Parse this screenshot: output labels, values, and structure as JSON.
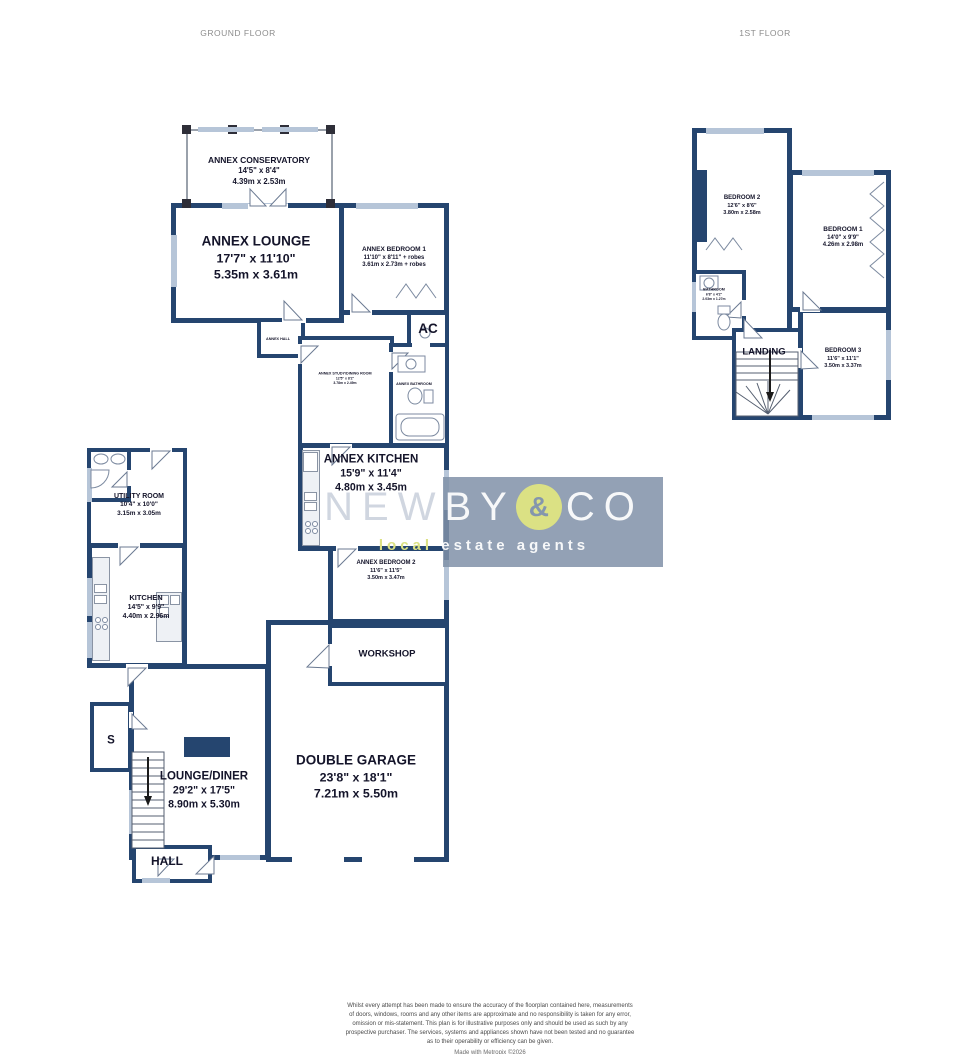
{
  "headers": {
    "ground_floor": "GROUND FLOOR",
    "first_floor": "1ST FLOOR"
  },
  "colors": {
    "wall": "#25456f",
    "window": "#b6c5d8",
    "watermark_band": "#8090a8",
    "logo_accent": "#dbe184"
  },
  "ground_floor": {
    "annex_conservatory": {
      "name": "ANNEX CONSERVATORY",
      "imperial": "14'5\" x 8'4\"",
      "metric": "4.39m x 2.53m"
    },
    "annex_lounge": {
      "name": "ANNEX LOUNGE",
      "imperial": "17'7\" x 11'10\"",
      "metric": "5.35m x 3.61m"
    },
    "annex_bedroom_1": {
      "name": "ANNEX BEDROOM 1",
      "imperial": "11'10\" x 8'11\" + robes",
      "metric": "3.61m x 2.73m + robes"
    },
    "ac": {
      "name": "AC"
    },
    "annex_hall": {
      "name": "ANNEX HALL"
    },
    "annex_study_dining": {
      "name": "ANNEX STUDY/DINING ROOM",
      "imperial": "12'5\" x 8'2\"",
      "metric": "3.78m x 2.49m"
    },
    "annex_bathroom": {
      "name": "ANNEX BATHROOM"
    },
    "annex_kitchen": {
      "name": "ANNEX KITCHEN",
      "imperial": "15'9\" x 11'4\"",
      "metric": "4.80m x 3.45m"
    },
    "annex_bedroom_2": {
      "name": "ANNEX BEDROOM 2",
      "imperial": "11'6\" x 11'5\"",
      "metric": "3.50m x 3.47m"
    },
    "utility_room": {
      "name": "UTILITY ROOM",
      "imperial": "10'4\" x 10'0\"",
      "metric": "3.15m x 3.05m"
    },
    "kitchen": {
      "name": "KITCHEN",
      "imperial": "14'5\" x 9'9\"",
      "metric": "4.40m x 2.96m"
    },
    "workshop": {
      "name": "WORKSHOP"
    },
    "double_garage": {
      "name": "DOUBLE GARAGE",
      "imperial": "23'8\" x 18'1\"",
      "metric": "7.21m x 5.50m"
    },
    "lounge_diner": {
      "name": "LOUNGE/DINER",
      "imperial": "29'2\" x 17'5\"",
      "metric": "8.90m x 5.30m"
    },
    "store": {
      "name": "S"
    },
    "hall": {
      "name": "HALL"
    }
  },
  "first_floor": {
    "bedroom_2": {
      "name": "BEDROOM 2",
      "imperial": "12'6\" x 8'6\"",
      "metric": "3.80m x 2.58m"
    },
    "bedroom_1": {
      "name": "BEDROOM 1",
      "imperial": "14'0\" x 9'9\"",
      "metric": "4.26m x 2.98m"
    },
    "bedroom_3": {
      "name": "BEDROOM 3",
      "imperial": "11'6\" x 11'1\"",
      "metric": "3.50m x 3.37m"
    },
    "landing": {
      "name": "LANDING"
    },
    "bathroom": {
      "name": "BATHROOM",
      "imperial": "6'8\" x 4'2\"",
      "metric": "2.03m x 1.27m"
    }
  },
  "watermark": {
    "brand_left": "NEW",
    "brand_mid": "BY",
    "ampersand": "&",
    "brand_right": "CO",
    "tagline_accent": "local",
    "tagline_rest": " estate agents"
  },
  "footer": {
    "disclaimer_lines": [
      "Whilst every attempt has been made to ensure the accuracy of the floorplan contained here, measurements",
      "of doors, windows, rooms and any other items are approximate and no responsibility is taken for any error,",
      "omission or mis-statement. This plan is for illustrative purposes only and should be used as such by any",
      "prospective purchaser. The services, systems and appliances shown have not been tested and no guarantee",
      "as to their operability or efficiency can be given."
    ],
    "credit": "Made with Metropix ©2026"
  }
}
